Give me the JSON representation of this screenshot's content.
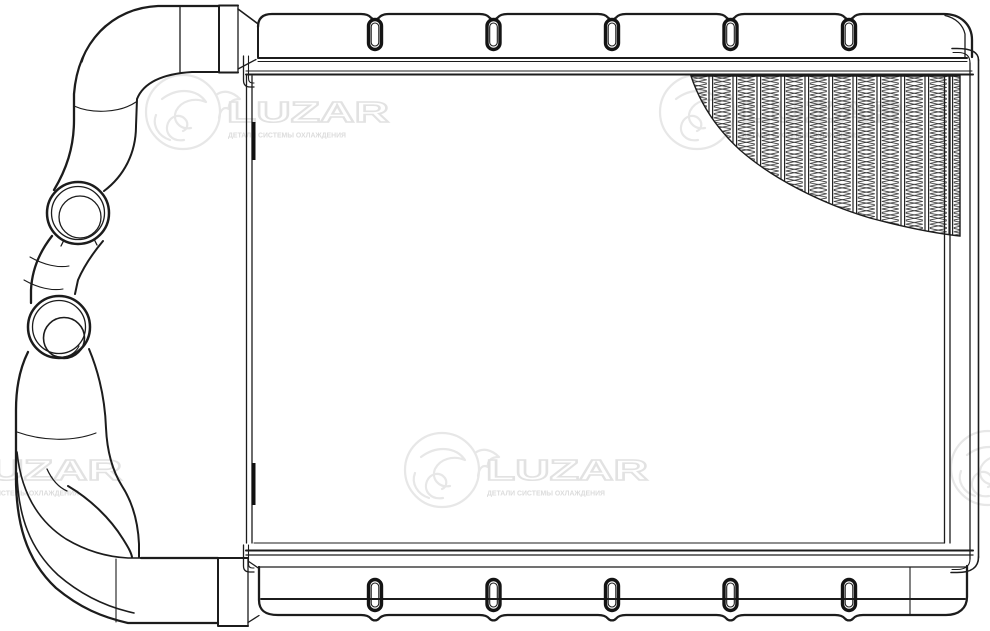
{
  "image": {
    "title": "Heater core technical line drawing",
    "background_color": "#ffffff",
    "line_color": "#1c1c1c"
  },
  "watermark": {
    "brand": "LUZAR",
    "tagline": "ДЕТАЛИ СИСТЕМЫ ОХЛАЖДЕНИЯ",
    "color": "#e7e7e7",
    "visible_instances": 5
  },
  "part": {
    "type": "heater-core-radiator",
    "top_tank_slots": 5,
    "bottom_tank_slots": 5,
    "pipe_fittings": 2
  }
}
